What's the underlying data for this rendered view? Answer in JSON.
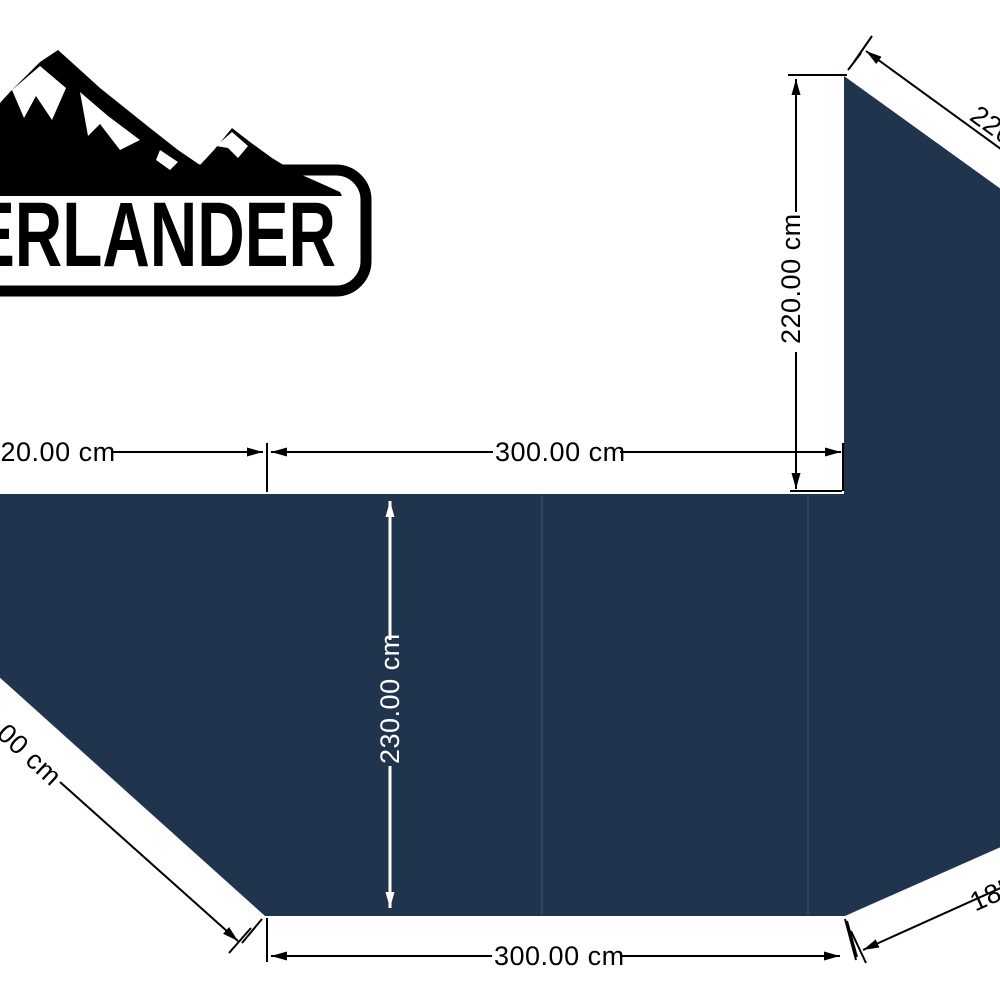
{
  "page": {
    "background": "#ffffff"
  },
  "logo": {
    "text": "OVERLANDER",
    "color": "#000000"
  },
  "shape": {
    "name": "awning-footprint",
    "fill": "#20344e",
    "seam_color": "rgba(255,255,255,0.10)"
  },
  "dimensions": {
    "left_offset_label": "220.00 cm",
    "top_span_label": "300.00 cm",
    "side_height_label": "220.00 cm",
    "depth_label": "230.00 cm",
    "bottom_span_label": "300.00 cm",
    "left_diagonal_label": "185.00 cm",
    "right_diagonal_label": "185.00 cm",
    "vehicle_side_label": "220.00 cm"
  },
  "annotation": {
    "line_color": "#000000",
    "inner_line_color": "#ffffff"
  }
}
